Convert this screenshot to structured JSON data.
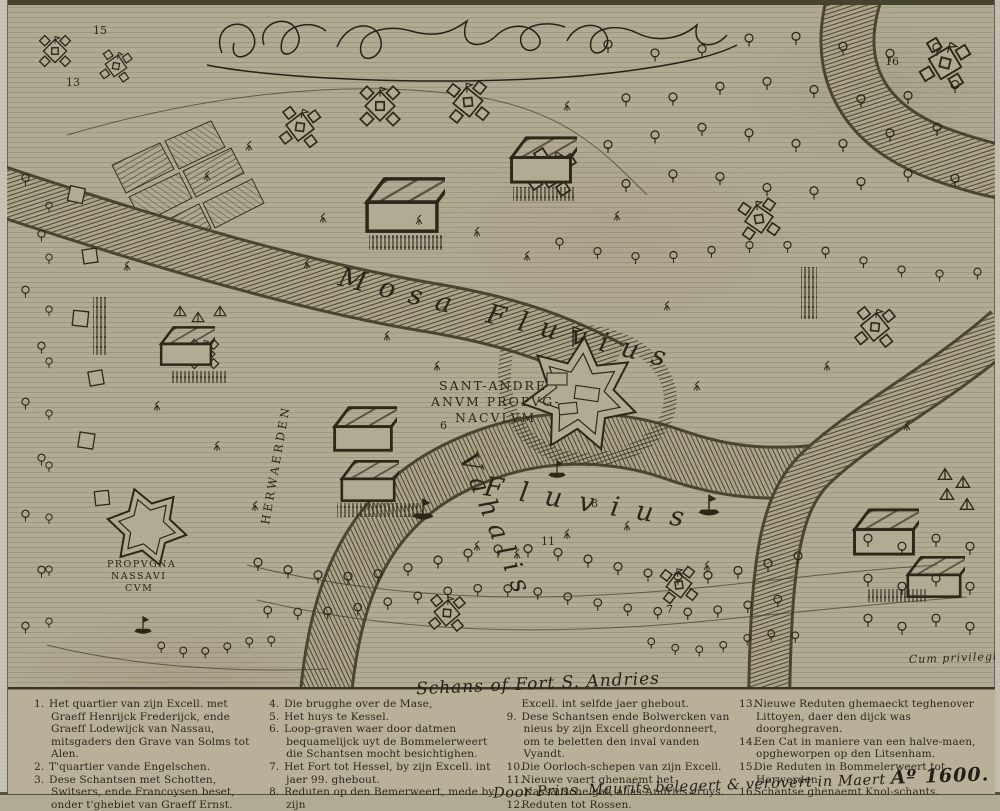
{
  "map": {
    "labels": {
      "fort_central_line1": "SANT-ANDRE",
      "fort_central_line2": "ANVM PROPVG-",
      "fort_central_line3": "NACVLVM",
      "fort_left_line1": "PROPVGNA",
      "fort_left_line2": "NASSAVI",
      "fort_left_line3": "CVM",
      "river_top": "Mosa Fluvius",
      "river_bottom_word1": "Vahalis",
      "river_bottom_word2": "Fluvius",
      "town_vertical": "HERWAERDEN",
      "privilege": "Cum privilegio"
    },
    "markers": [
      {
        "n": "15",
        "x": 86,
        "y": 29
      },
      {
        "n": "13",
        "x": 59,
        "y": 81
      },
      {
        "n": "16",
        "x": 878,
        "y": 60
      },
      {
        "n": "6",
        "x": 433,
        "y": 424
      },
      {
        "n": "8",
        "x": 584,
        "y": 502
      },
      {
        "n": "11",
        "x": 534,
        "y": 540
      },
      {
        "n": "7",
        "x": 659,
        "y": 608
      }
    ]
  },
  "legend": {
    "handwritten_title": "Schans of Fort S. Andries",
    "columns": [
      [
        {
          "n": "1.",
          "t": "Het quartier van zijn Excell. met Graeff Henrijck Frederijck, ende Graeff Lodewijck van Nassau, mitsgaders den Grave van Solms tot Alen."
        },
        {
          "n": "2.",
          "t": "T'quartier vande Engelschen."
        },
        {
          "n": "3.",
          "t": "Dese Schantsen met Schotten, Switsers, ende Francoysen beset, onder t'ghebiet van Graeff Ernst."
        }
      ],
      [
        {
          "n": "4.",
          "t": "Die brugghe over de Mase,"
        },
        {
          "n": "5.",
          "t": "Het huys te Kessel."
        },
        {
          "n": "6.",
          "t": "Loop-graven waer door datmen bequamelijck uyt de Bommelerweert die Schantsen mocht besichtighen."
        },
        {
          "n": "7.",
          "t": "Het Fort tot Hessel, by zijn Excell. int jaer 99. ghebout."
        },
        {
          "n": "8.",
          "t": "Reduten op den Bemerweert, mede by zijn"
        }
      ],
      [
        {
          "n": "",
          "t": "Excell. int selfde jaer ghebout."
        },
        {
          "n": "9.",
          "t": "Dese Schantsen ende Bolwercken van nieus by zijn Excell gheordonneert, om te beletten den inval vanden Vyandt."
        },
        {
          "n": "10.",
          "t": "Die Oorloch-schepen van zijn Excell."
        },
        {
          "n": "11.",
          "t": "Nieuwe vaert ghenaemt het Nassausche gat, alias Andries cruys."
        },
        {
          "n": "12.",
          "t": "Reduten tot Rossen."
        }
      ],
      [
        {
          "n": "13.",
          "t": "Nieuwe Reduten ghemaeckt teghenover Littoyen, daer den dijck was doorghegraven."
        },
        {
          "n": "14.",
          "t": "Een Cat in maniere van een halve-maen, opgheworpen op den Litsenham."
        },
        {
          "n": "15.",
          "t": "Die Reduten in Bommelerweert tot Herwerden."
        },
        {
          "n": "16.",
          "t": "Schantse ghenaemt Knol-schants."
        }
      ]
    ],
    "attribution_text": "Door Prins. Maurits belegert & verovert in Maert",
    "attribution_year": "Aº 1600."
  }
}
